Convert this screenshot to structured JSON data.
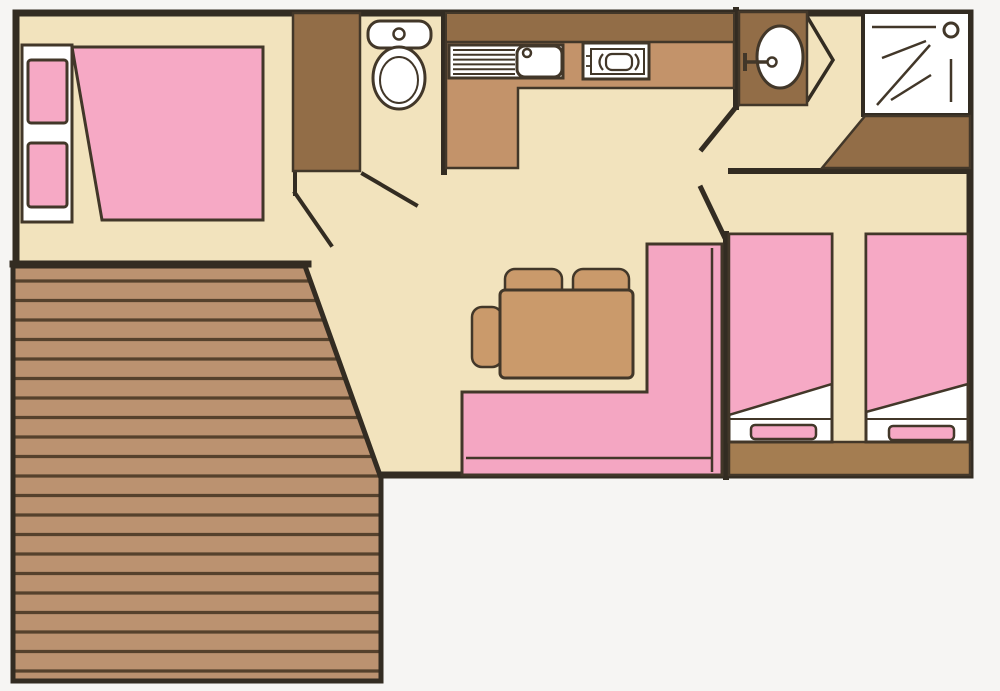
{
  "canvas": {
    "width": 1000,
    "height": 691
  },
  "palette": {
    "background": "#f6f5f3",
    "floor": "#f2e3bd",
    "wall": "#332c22",
    "outline": "#423729",
    "wood_dark": "#926d47",
    "wood_counter": "#c3936a",
    "wood_chest": "#a47d51",
    "wood_table": "#ca9a6b",
    "deck": "#bb9270",
    "deck_line": "#55412c",
    "pink": "#f6a9c5",
    "pink_bench": "#f4a6c2",
    "white": "#ffffff"
  },
  "inventory": {
    "type": "mobile-home floor plan",
    "rooms": [
      "double bedroom",
      "toilet",
      "kitchen",
      "washroom",
      "shower room",
      "twin bedroom",
      "living-dining area",
      "deck terrace"
    ],
    "fixtures": [
      "double-bed",
      "wardrobe",
      "toilet",
      "sink-with-drainer",
      "two-burner-hob",
      "washbasin",
      "shower",
      "storage-cabinet",
      "single-bed",
      "single-bed",
      "storage-chest",
      "dining-table",
      "chair",
      "chair",
      "chair",
      "corner-bench",
      "wood-deck"
    ]
  }
}
